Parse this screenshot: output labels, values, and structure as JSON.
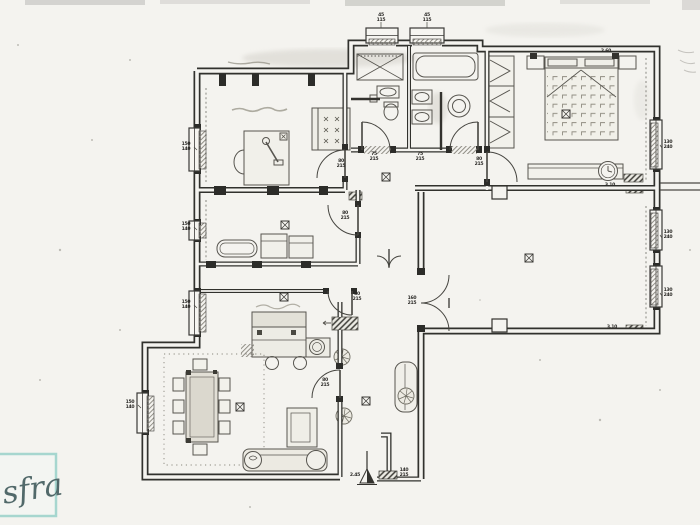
{
  "document": {
    "kind": "scanned hand-drawn apartment floor plan",
    "paper_color": "#f4f3ef",
    "ink_color": "#33322e",
    "pencil_color": "#6e6c64",
    "watermark_box_color": "#a6d6cf",
    "watermark_script_color": "#51696a"
  },
  "watermark": {
    "text": "sfra"
  },
  "rooms": [
    {
      "name": "study"
    },
    {
      "name": "bathroom-1"
    },
    {
      "name": "bathroom-2"
    },
    {
      "name": "master-bedroom"
    },
    {
      "name": "bedroom-2"
    },
    {
      "name": "corridor"
    },
    {
      "name": "hall"
    },
    {
      "name": "kitchen"
    },
    {
      "name": "dining-living"
    },
    {
      "name": "living-room"
    },
    {
      "name": "entry"
    }
  ],
  "annotations": {
    "dims": [
      {
        "x": 186,
        "y": 145,
        "lines": [
          "150",
          "140"
        ],
        "lead": [
          197,
          150
        ]
      },
      {
        "x": 186,
        "y": 225,
        "lines": [
          "150",
          "140"
        ],
        "lead": [
          197,
          230
        ]
      },
      {
        "x": 186,
        "y": 303,
        "lines": [
          "150",
          "140"
        ],
        "lead": [
          197,
          308
        ]
      },
      {
        "x": 130,
        "y": 403,
        "lines": [
          "150",
          "140"
        ],
        "lead": [
          141,
          408
        ]
      },
      {
        "x": 381,
        "y": 16,
        "lines": [
          "45",
          "115"
        ],
        "lead": [
          381,
          28
        ]
      },
      {
        "x": 427,
        "y": 16,
        "lines": [
          "45",
          "115"
        ],
        "lead": [
          427,
          28
        ]
      },
      {
        "x": 341,
        "y": 162,
        "lines": [
          "80",
          "215"
        ]
      },
      {
        "x": 345,
        "y": 214,
        "lines": [
          "80",
          "215"
        ]
      },
      {
        "x": 357,
        "y": 295,
        "lines": [
          "80",
          "215"
        ]
      },
      {
        "x": 479,
        "y": 160,
        "lines": [
          "80",
          "215"
        ]
      },
      {
        "x": 374,
        "y": 155,
        "lines": [
          "75",
          "215"
        ]
      },
      {
        "x": 420,
        "y": 155,
        "lines": [
          "75",
          "215"
        ]
      },
      {
        "x": 325,
        "y": 381,
        "lines": [
          "80",
          "215"
        ]
      },
      {
        "x": 668,
        "y": 143,
        "lines": [
          "130",
          "240"
        ],
        "lead": [
          662,
          148
        ]
      },
      {
        "x": 668,
        "y": 233,
        "lines": [
          "130",
          "240"
        ],
        "lead": [
          662,
          238
        ]
      },
      {
        "x": 668,
        "y": 291,
        "lines": [
          "130",
          "240"
        ],
        "lead": [
          662,
          296
        ]
      },
      {
        "x": 412,
        "y": 299,
        "lines": [
          "160",
          "215"
        ]
      },
      {
        "x": 612,
        "y": 328,
        "lines": [
          "3.10"
        ]
      },
      {
        "x": 610,
        "y": 186,
        "lines": [
          "3.10"
        ]
      },
      {
        "x": 606,
        "y": 52,
        "lines": [
          "2.60"
        ]
      },
      {
        "x": 355,
        "y": 476,
        "lines": [
          "2.45"
        ]
      },
      {
        "x": 404,
        "y": 471,
        "lines": [
          "140",
          "215"
        ]
      }
    ]
  }
}
